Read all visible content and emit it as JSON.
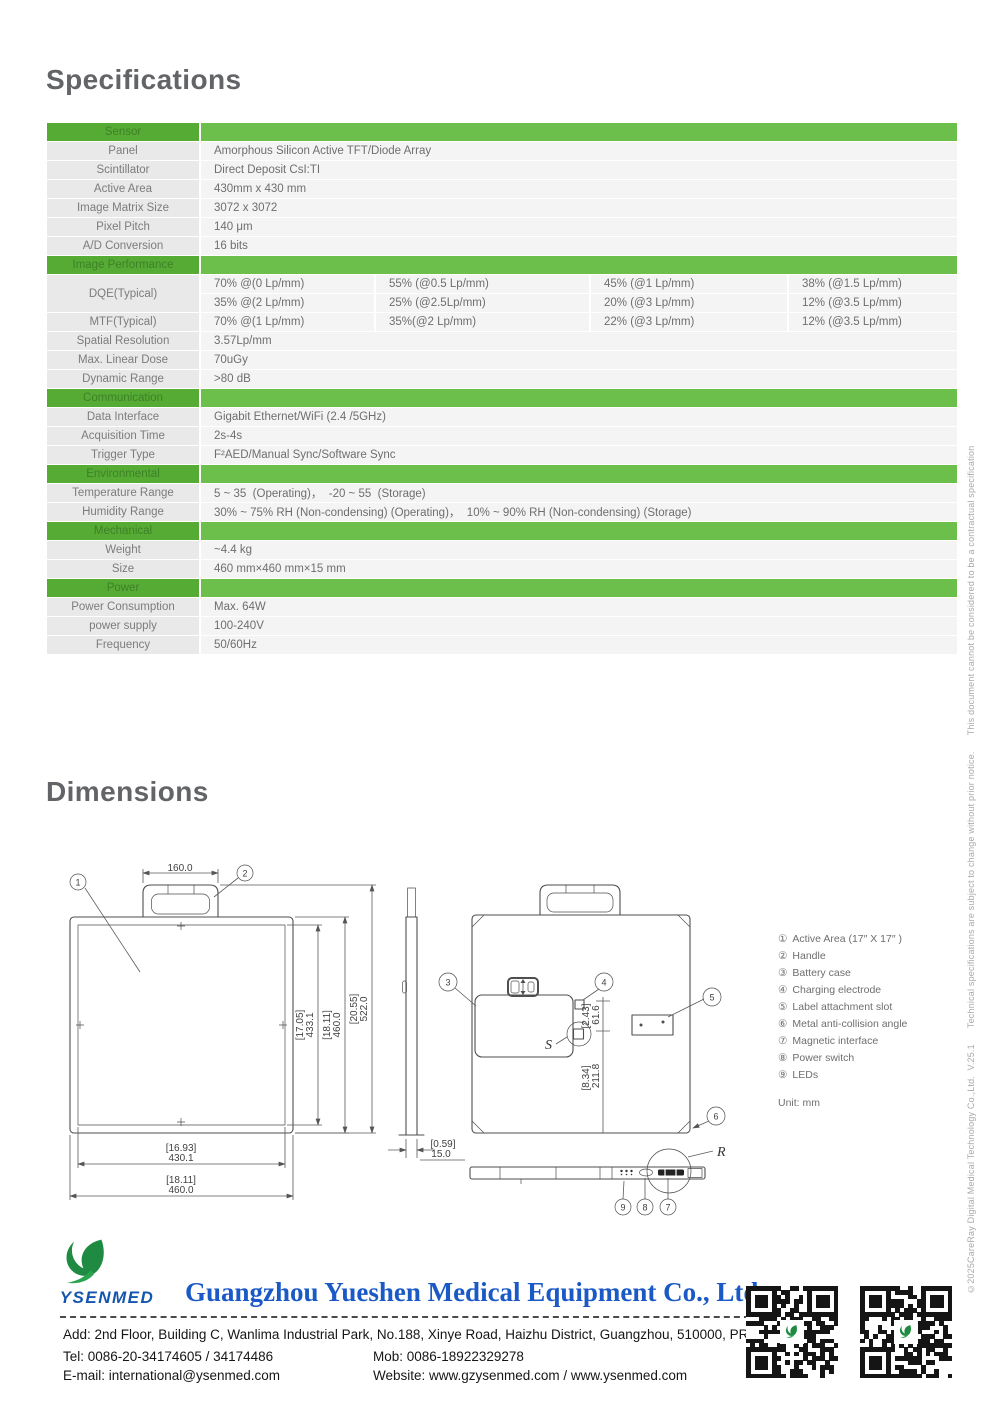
{
  "titles": {
    "specifications": "Specifications",
    "dimensions": "Dimensions"
  },
  "specs": {
    "sections": [
      {
        "title": "Sensor",
        "rows": [
          {
            "l": "Panel",
            "v": "Amorphous Silicon Active TFT/Diode Array"
          },
          {
            "l": "Scintillator",
            "v": "Direct Deposit CsI:TI"
          },
          {
            "l": "Active Area",
            "v": "430mm x 430 mm"
          },
          {
            "l": "Image Matrix Size",
            "v": "3072 x 3072"
          },
          {
            "l": "Pixel Pitch",
            "v": "140 μm"
          },
          {
            "l": "A/D Conversion",
            "v": "16 bits"
          }
        ]
      },
      {
        "title": "Image Performance",
        "dqe_label": "DQE(Typical)",
        "dqe1": [
          "70% @(0 Lp/mm)",
          "55% (@0.5 Lp/mm)",
          "45% (@1 Lp/mm)",
          "38% (@1.5 Lp/mm)"
        ],
        "dqe2": [
          "35% @(2 Lp/mm)",
          "25% (@2.5Lp/mm)",
          "20% (@3 Lp/mm)",
          "12% (@3.5 Lp/mm)"
        ],
        "mtf_label": "MTF(Typical)",
        "mtf": [
          "70% @(1 Lp/mm)",
          "35%(@2 Lp/mm)",
          "22% (@3 Lp/mm)",
          "12% (@3.5 Lp/mm)"
        ],
        "rows": [
          {
            "l": "Spatial Resolution",
            "v": "3.57Lp/mm"
          },
          {
            "l": "Max. Linear Dose",
            "v": "70uGy"
          },
          {
            "l": "Dynamic Range",
            "v": ">80 dB"
          }
        ]
      },
      {
        "title": "Communication",
        "rows": [
          {
            "l": "Data Interface",
            "v": "Gigabit Ethernet/WiFi (2.4 /5GHz)"
          },
          {
            "l": "Acquisition Time",
            "v": "2s-4s"
          },
          {
            "l": "Trigger Type",
            "v": "F²AED/Manual Sync/Software Sync"
          }
        ]
      },
      {
        "title": "Environmental",
        "rows": [
          {
            "l": "Temperature Range",
            "v": "5 ~ 35  (Operating)，  -20 ~ 55  (Storage)"
          },
          {
            "l": "Humidity Range",
            "v": "30% ~ 75% RH (Non-condensing) (Operating)，  10% ~ 90% RH (Non-condensing) (Storage)"
          }
        ]
      },
      {
        "title": "Mechanical",
        "rows": [
          {
            "l": "Weight",
            "v": "~4.4 kg"
          },
          {
            "l": "Size",
            "v": "460 mm×460 mm×15 mm"
          }
        ]
      },
      {
        "title": "Power",
        "rows": [
          {
            "l": "Power Consumption",
            "v": "Max. 64W"
          },
          {
            "l": "power supply",
            "v": "100-240V"
          },
          {
            "l": "Frequency",
            "v": "50/60Hz"
          }
        ]
      }
    ]
  },
  "drawing": {
    "d160": "160.0",
    "a_in": "[17.05]",
    "a_mm": "433.1",
    "b_in": "[18.11]",
    "b_mm": "460.0",
    "c_in": "[20.55]",
    "c_mm": "522.0",
    "w_in": "[16.93]",
    "w_mm": "430.1",
    "t_in": "[0.59]",
    "t_mm": "15.0",
    "e_in": "[2.43]",
    "e_mm": "61.6",
    "f_in": "[8.34]",
    "f_mm": "211.8",
    "s": "S",
    "r": "R",
    "callouts": {
      "c1": "1",
      "c2": "2",
      "c3": "3",
      "c4": "4",
      "c5": "5",
      "c6": "6",
      "c7": "7",
      "c8": "8",
      "c9": "9"
    }
  },
  "legend": {
    "items": [
      {
        "n": "①",
        "t": "Active Area (17″ X 17″ )"
      },
      {
        "n": "②",
        "t": "Handle"
      },
      {
        "n": "③",
        "t": "Battery case"
      },
      {
        "n": "④",
        "t": "Charging electrode"
      },
      {
        "n": "⑤",
        "t": "Label attachment slot"
      },
      {
        "n": "⑥",
        "t": "Metal anti-collision angle"
      },
      {
        "n": "⑦",
        "t": "Magnetic interface"
      },
      {
        "n": "⑧",
        "t": "Power switch"
      },
      {
        "n": "⑨",
        "t": "LEDs"
      }
    ],
    "unit": "Unit: mm"
  },
  "side_note": "©2025CareRay Digital Medical Technology Co.,Ltd.  V.25.1      Technical specifications are subject to change without prior notice.      This document cannot be considered to be a contractual specification",
  "footer": {
    "logo_text": "YSENMED",
    "company": "Guangzhou Yueshen Medical Equipment Co., Ltd.",
    "address": "Add: 2nd Floor, Building C, Wanlima Industrial Park, No.188, Xinye Road, Haizhu District, Guangzhou, 510000, PRC",
    "tel": "Tel: 0086-20-34174605 / 34174486",
    "mob": "Mob: 0086-18922329278",
    "email": "E-mail: international@ysenmed.com",
    "website": "Website: www.gzysenmed.com / www.ysenmed.com"
  }
}
